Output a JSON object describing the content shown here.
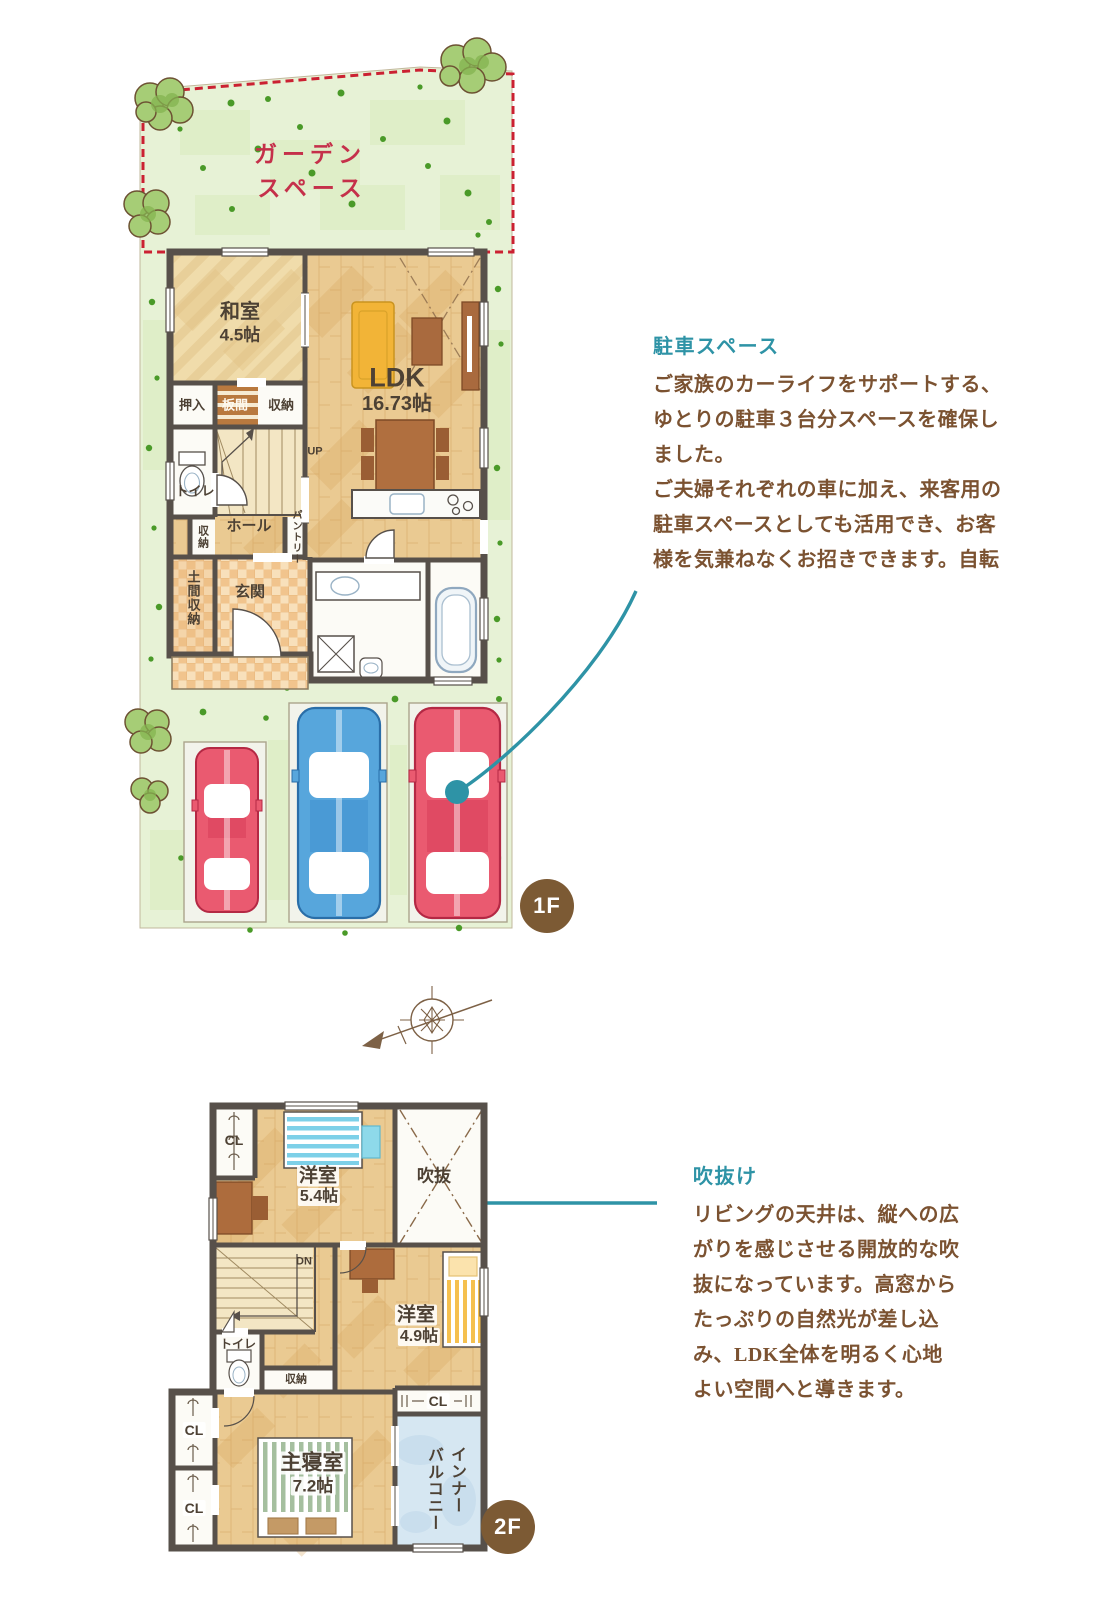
{
  "colors": {
    "teal": "#2e93a6",
    "note_brown": "#7b5231",
    "badge_brown": "#7c5a34",
    "garden_red": "#c5304a",
    "dash_red": "#cb2132"
  },
  "floor1": {
    "badge": "1F",
    "garden": {
      "line1": "ガーデン",
      "line2": "スペース"
    },
    "rooms": {
      "washitsu": "和室",
      "washitsu_size": "4.5帖",
      "oshiire": "押入",
      "itanoma": "板間",
      "shunou_a": "収納",
      "toilet": "トイレ",
      "shunou_b": "収納",
      "hall": "ホール",
      "pantry": "パントリー",
      "doma": "土間収納",
      "genkan": "玄関",
      "stairs_up": "UP",
      "ldk": "LDK",
      "ldk_size": "16.73帖"
    }
  },
  "floor2": {
    "badge": "2F",
    "rooms": {
      "cl_a": "CL",
      "yoshitsu1": "洋室",
      "yoshitsu1_size": "5.4帖",
      "fukinuke": "吹抜",
      "stairs_dn": "DN",
      "toilet": "トイレ",
      "shunou": "収納",
      "yoshitsu2": "洋室",
      "yoshitsu2_size": "4.9帖",
      "cl_b": "CL",
      "cl_c": "CL",
      "cl_d": "CL",
      "shushinshitsu": "主寝室",
      "shushinshitsu_size": "7.2帖",
      "balcony_line1": "インナー",
      "balcony_line2": "バルコニー"
    }
  },
  "annotations": {
    "parking": {
      "title": "駐車スペース",
      "lines": [
        "ご家族のカーライフをサポートする、",
        "ゆとりの駐車３台分スペースを確保し",
        "ました。",
        "ご夫婦それぞれの車に加え、来客用の",
        "駐車スペースとしても活用でき、お客",
        "様を気兼ねなくお招きできます。自転"
      ]
    },
    "void": {
      "title": "吹抜け",
      "lines": [
        "リビングの天井は、縦への広",
        "がりを感じさせる開放的な吹",
        "抜になっています。高窓から",
        "たっぷりの自然光が差し込",
        "み、LDK全体を明るく心地",
        "よい空間へと導きます。"
      ]
    }
  }
}
